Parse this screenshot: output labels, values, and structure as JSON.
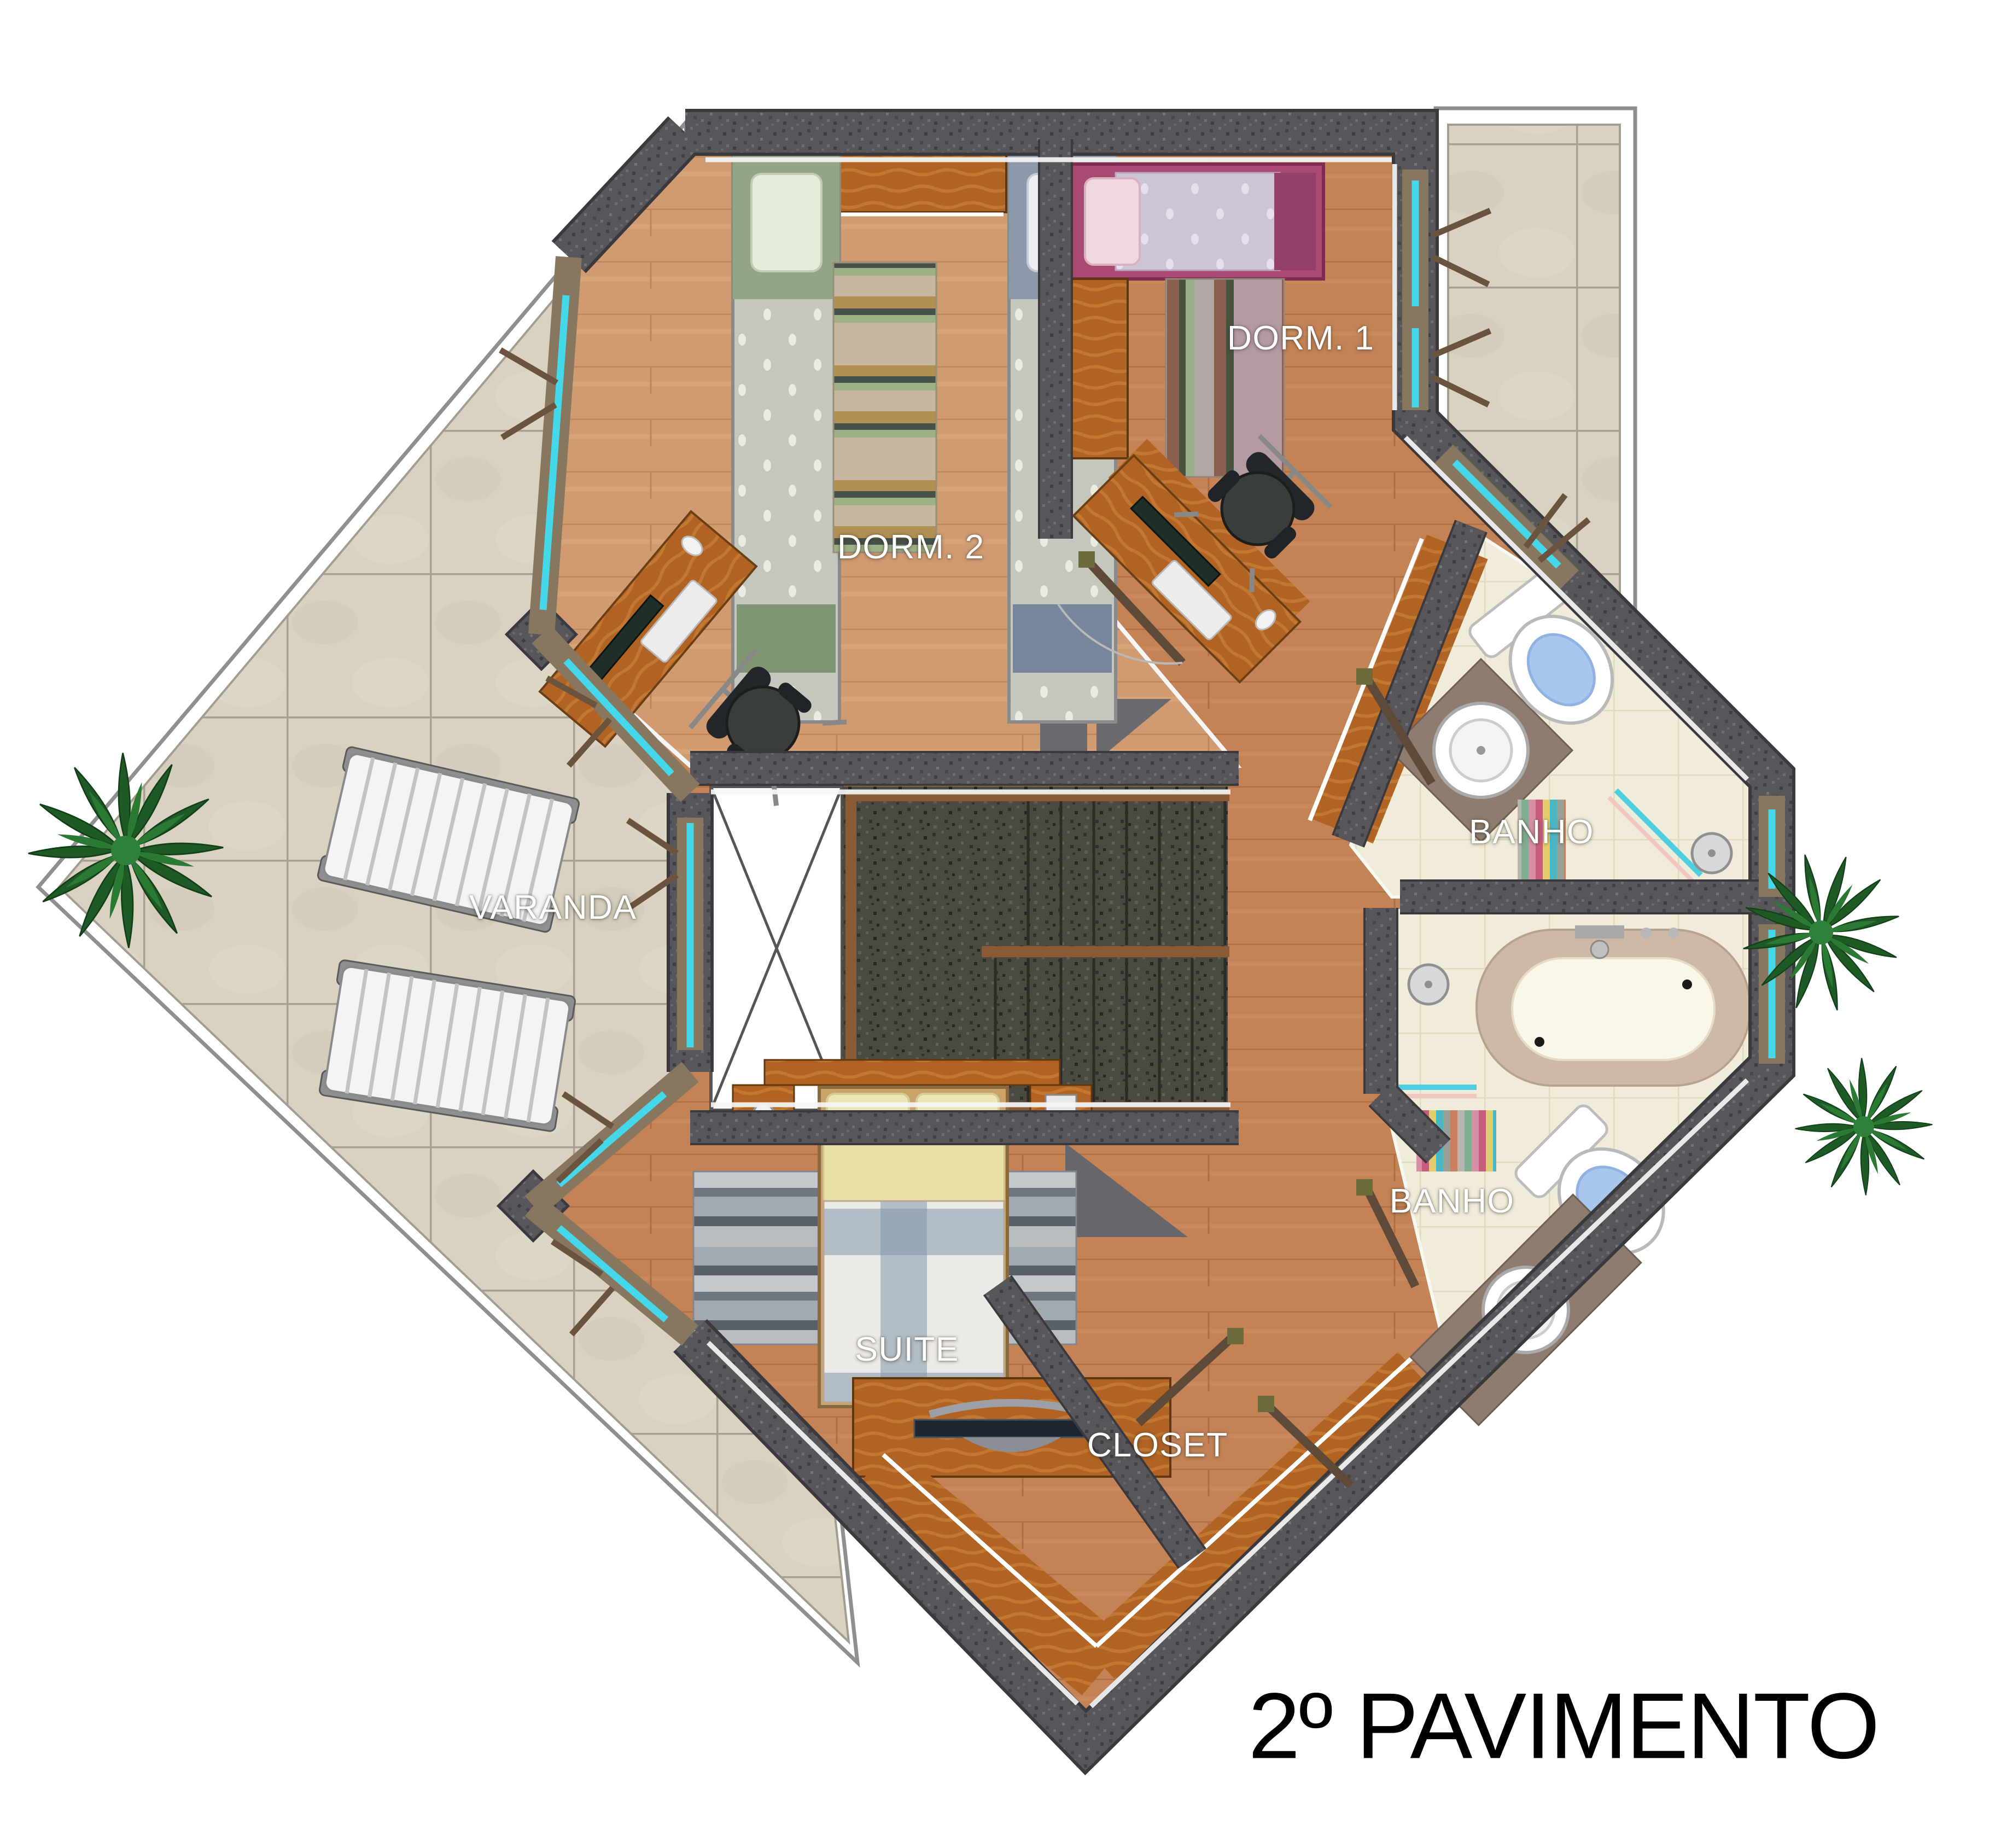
{
  "title": {
    "text": "2º PAVIMENTO"
  },
  "rooms": {
    "dorm1": {
      "label": "DORM. 1"
    },
    "dorm2": {
      "label": "DORM. 2"
    },
    "varanda": {
      "label": "VARANDA"
    },
    "banho1": {
      "label": "BANHO"
    },
    "banho2": {
      "label": "BANHO"
    },
    "suite": {
      "label": "SUITE"
    },
    "closet": {
      "label": "CLOSET"
    }
  },
  "colors": {
    "wall_granite": "#57565b",
    "stair_granite": "#4a4a42",
    "floor_wood": "#c38355",
    "floor_wood_light": "#d09b70",
    "terrace_tile": "#d9d2c1",
    "bath_tile": "#f1ecd9",
    "window_glass": "#45d8ea",
    "furniture_wood": "#b06323",
    "plant_green": "#2a7a33"
  }
}
